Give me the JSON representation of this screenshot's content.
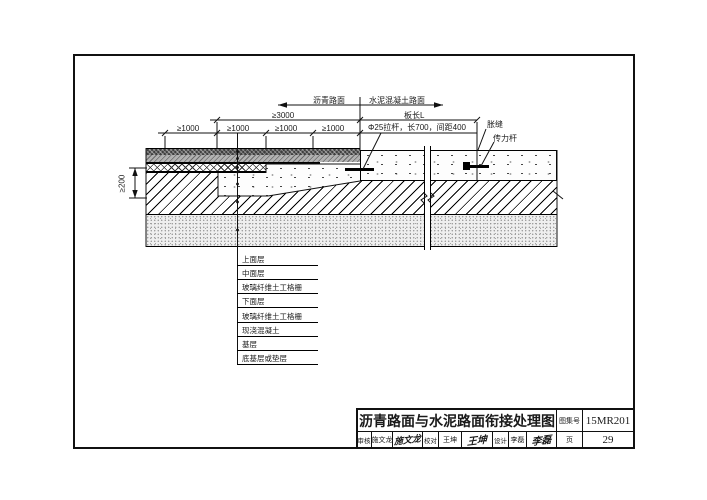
{
  "ann": {
    "asphalt": "沥青路面",
    "concrete_road": "水泥混凝土路面",
    "dim3000": "≥3000",
    "slab_len": "板长L",
    "dim1000": [
      "≥1000",
      "≥1000",
      "≥1000",
      "≥1000"
    ],
    "tie_bar": "Φ25拉杆，长700，间距400",
    "exp_joint": "胀缝",
    "dowel": "传力杆",
    "dim200": "≥200"
  },
  "layers": {
    "items": [
      "上面层",
      "中面层",
      "玻璃纤维土工格栅",
      "下面层",
      "玻璃纤维土工格栅",
      "现浇混凝土",
      "基层",
      "底基层或垫层"
    ]
  },
  "tb": {
    "title": "沥青路面与水泥路面衔接处理图",
    "atlas_label": "图集号",
    "atlas_number": "15MR201",
    "page_label": "页",
    "page_number": "29",
    "reviewer_label": "审核",
    "reviewer_name": "施文龙",
    "reviewer_sig": "施文龙",
    "checker_label": "校对",
    "checker_name": "王坤",
    "checker_sig": "王坤",
    "designer_label": "设计",
    "designer_name": "李磊",
    "designer_sig": "李磊"
  }
}
